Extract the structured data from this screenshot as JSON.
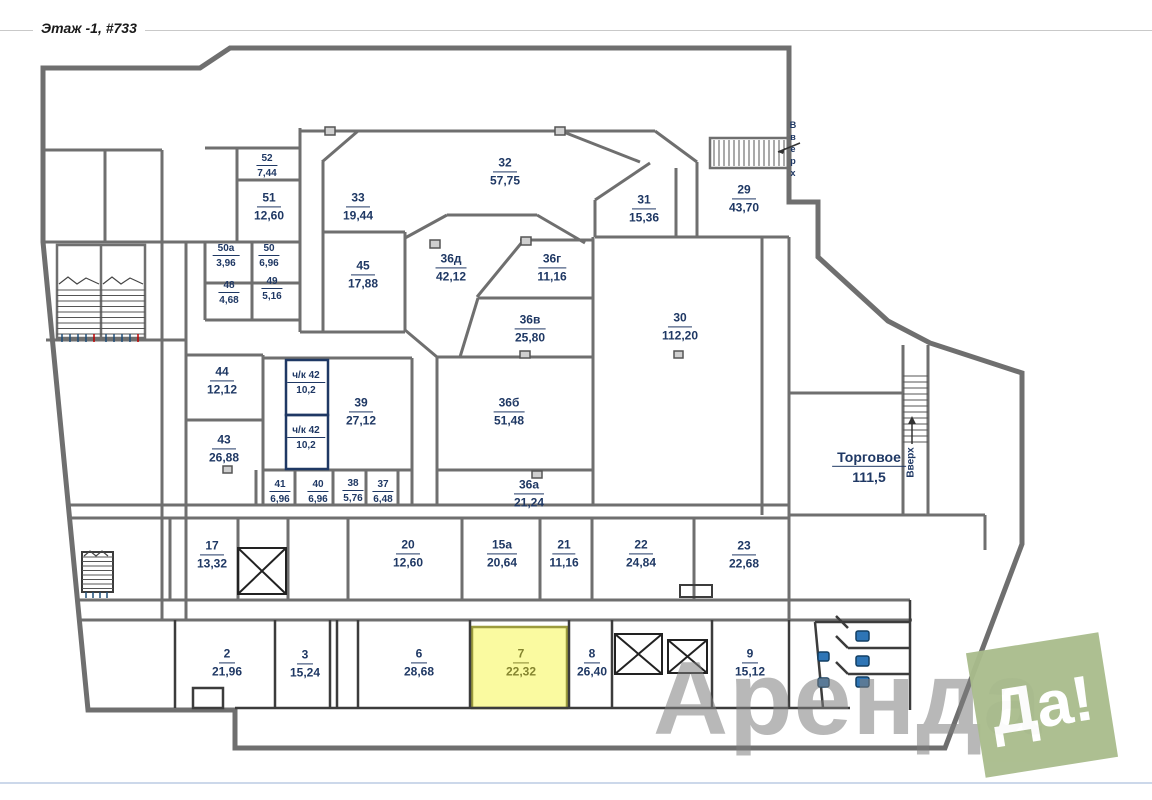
{
  "title": "Этаж -1, #733",
  "labels": {
    "stairs_up_top_right": "Вверх",
    "stairs_up_mid_right": "Вверх"
  },
  "watermark": {
    "text_gray": "Аренда",
    "text_badge": "Да!",
    "badge_color": "#a9bc8c",
    "gray_color": "#7f7f7f"
  },
  "colors": {
    "wall": "#6f6f6f",
    "wall_dark": "#3c3c3c",
    "label": "#1f3864",
    "special_room_wall": "#1f3864",
    "highlight_fill": "#fafaa0",
    "highlight_stroke": "#9b9b3d",
    "highlight_label": "#84842f",
    "fixture_fill": "#2e75b6"
  },
  "rooms": [
    {
      "number": "52",
      "area": "7,44",
      "x": 267,
      "y": 166,
      "size": "s"
    },
    {
      "number": "51",
      "area": "12,60",
      "x": 269,
      "y": 207,
      "size": "m"
    },
    {
      "number": "50а",
      "area": "3,96",
      "x": 226,
      "y": 256,
      "size": "s"
    },
    {
      "number": "50",
      "area": "6,96",
      "x": 269,
      "y": 256,
      "size": "s"
    },
    {
      "number": "48",
      "area": "4,68",
      "x": 229,
      "y": 293,
      "size": "s"
    },
    {
      "number": "49",
      "area": "5,16",
      "x": 272,
      "y": 289,
      "size": "s"
    },
    {
      "number": "33",
      "area": "19,44",
      "x": 358,
      "y": 207,
      "size": "m"
    },
    {
      "number": "32",
      "area": "57,75",
      "x": 505,
      "y": 172,
      "size": "m"
    },
    {
      "number": "31",
      "area": "15,36",
      "x": 644,
      "y": 209,
      "size": "m"
    },
    {
      "number": "29",
      "area": "43,70",
      "x": 744,
      "y": 199,
      "size": "m"
    },
    {
      "number": "45",
      "area": "17,88",
      "x": 363,
      "y": 275,
      "size": "m"
    },
    {
      "number": "36д",
      "area": "42,12",
      "x": 451,
      "y": 268,
      "size": "m"
    },
    {
      "number": "36г",
      "area": "11,16",
      "x": 552,
      "y": 268,
      "size": "m"
    },
    {
      "number": "36в",
      "area": "25,80",
      "x": 530,
      "y": 329,
      "size": "m"
    },
    {
      "number": "30",
      "area": "112,20",
      "x": 680,
      "y": 327,
      "size": "m"
    },
    {
      "number": "44",
      "area": "12,12",
      "x": 222,
      "y": 381,
      "size": "m"
    },
    {
      "number": "ч/к 42",
      "area": "10,2",
      "x": 306,
      "y": 383,
      "size": "s"
    },
    {
      "number": "ч/к 42",
      "area": "10,2",
      "x": 306,
      "y": 438,
      "size": "s"
    },
    {
      "number": "39",
      "area": "27,12",
      "x": 361,
      "y": 412,
      "size": "m"
    },
    {
      "number": "36б",
      "area": "51,48",
      "x": 509,
      "y": 412,
      "size": "m"
    },
    {
      "number": "43",
      "area": "26,88",
      "x": 224,
      "y": 449,
      "size": "m"
    },
    {
      "number": "41",
      "area": "6,96",
      "x": 280,
      "y": 492,
      "size": "s"
    },
    {
      "number": "40",
      "area": "6,96",
      "x": 318,
      "y": 492,
      "size": "s"
    },
    {
      "number": "38",
      "area": "5,76",
      "x": 353,
      "y": 491,
      "size": "s"
    },
    {
      "number": "37",
      "area": "6,48",
      "x": 383,
      "y": 492,
      "size": "s"
    },
    {
      "number": "36а",
      "area": "21,24",
      "x": 529,
      "y": 494,
      "size": "m"
    },
    {
      "number": "Торговое",
      "area": "111,5",
      "x": 869,
      "y": 467,
      "size": "l"
    },
    {
      "number": "17",
      "area": "13,32",
      "x": 212,
      "y": 555,
      "size": "m"
    },
    {
      "number": "20",
      "area": "12,60",
      "x": 408,
      "y": 554,
      "size": "m"
    },
    {
      "number": "15а",
      "area": "20,64",
      "x": 502,
      "y": 554,
      "size": "m"
    },
    {
      "number": "21",
      "area": "11,16",
      "x": 564,
      "y": 554,
      "size": "m"
    },
    {
      "number": "22",
      "area": "24,84",
      "x": 641,
      "y": 554,
      "size": "m"
    },
    {
      "number": "23",
      "area": "22,68",
      "x": 744,
      "y": 555,
      "size": "m"
    },
    {
      "number": "2",
      "area": "21,96",
      "x": 227,
      "y": 663,
      "size": "m"
    },
    {
      "number": "3",
      "area": "15,24",
      "x": 305,
      "y": 664,
      "size": "m"
    },
    {
      "number": "6",
      "area": "28,68",
      "x": 419,
      "y": 663,
      "size": "m"
    },
    {
      "number": "7",
      "area": "22,32",
      "x": 521,
      "y": 663,
      "size": "m",
      "highlighted": true
    },
    {
      "number": "8",
      "area": "26,40",
      "x": 592,
      "y": 663,
      "size": "m"
    },
    {
      "number": "9",
      "area": "15,12",
      "x": 750,
      "y": 663,
      "size": "m"
    }
  ]
}
